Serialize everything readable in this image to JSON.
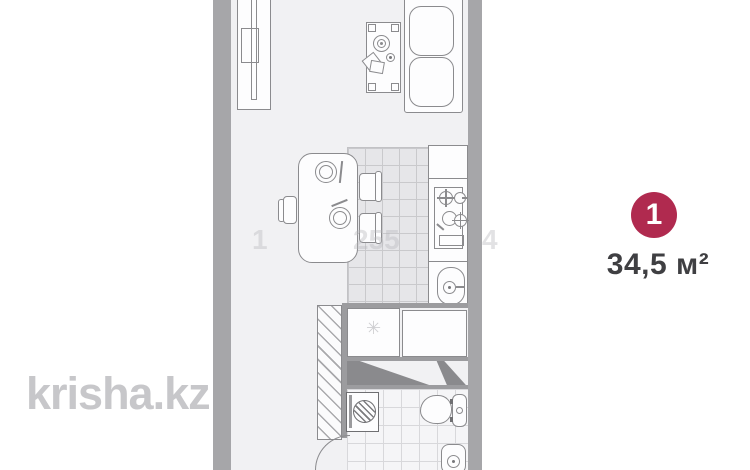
{
  "floorplan": {
    "unit_badge": {
      "number": "1",
      "color": "#b02a4f"
    },
    "area_label": "34,5 м²",
    "fridge_glyph": "✳"
  },
  "watermarks": {
    "site": "krisha.kz",
    "phone_fragments": [
      "1",
      "255",
      "4"
    ]
  },
  "colors": {
    "wall": "#a6a6a9",
    "floor": "#f1f1f3",
    "kitchen_tile": "#e6e6e9",
    "bathroom_tile": "#f5f5f7",
    "badge": "#b02a4f",
    "area_text": "#3f3f42",
    "watermark": "#c7c7ca"
  }
}
